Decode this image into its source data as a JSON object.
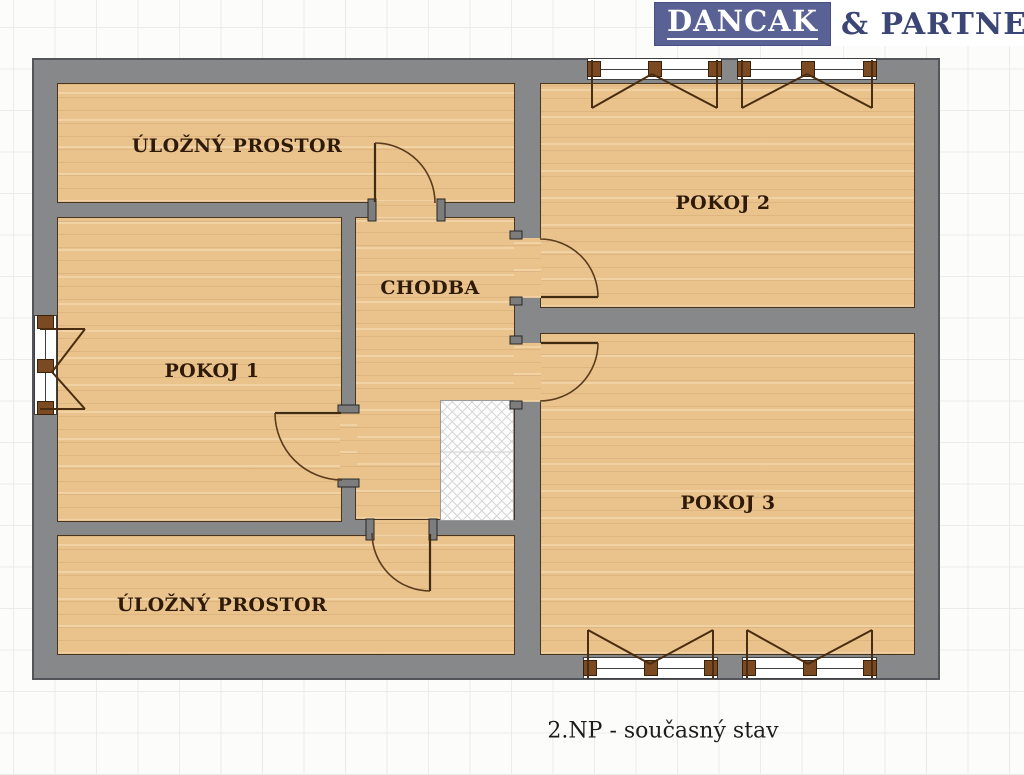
{
  "logo": {
    "primary": "DANCAK",
    "secondary": "& PARTNERS"
  },
  "floor_plan": {
    "title_type": "apartment floor plan",
    "caption": "2.NP - současný stav",
    "rooms": [
      {
        "id": "storage-top",
        "label": "ÚLOŽNÝ PROSTOR"
      },
      {
        "id": "pokoj-2",
        "label": "POKOJ 2"
      },
      {
        "id": "pokoj-1",
        "label": "POKOJ 1"
      },
      {
        "id": "chodba",
        "label": "CHODBA"
      },
      {
        "id": "pokoj-3",
        "label": "POKOJ 3"
      },
      {
        "id": "storage-bottom",
        "label": "ÚLOŽNÝ PROSTOR"
      }
    ],
    "features": {
      "windows": [
        "left-double-casement",
        "top-double-casement-1",
        "top-double-casement-2",
        "bottom-double-casement-1",
        "bottom-double-casement-2"
      ],
      "doors": [
        "storage-top-door",
        "pokoj-1-door",
        "pokoj-2-door",
        "pokoj-3-door",
        "storage-bottom-door"
      ],
      "stair_shaft_hatch": true
    }
  },
  "colors": {
    "wall": "#87888a",
    "wall_outline": "#54555a",
    "floor_wood": "#eac28c",
    "floor_outline": "#4a341c",
    "label_text": "#2e1a08",
    "door_line": "#5c3c1e",
    "window_block": "#7b4a22",
    "logo_bg": "#5a6295",
    "logo_text": "#ffffff",
    "logo_suffix_text": "#3b4677",
    "grid_line": "#ecebe8"
  }
}
